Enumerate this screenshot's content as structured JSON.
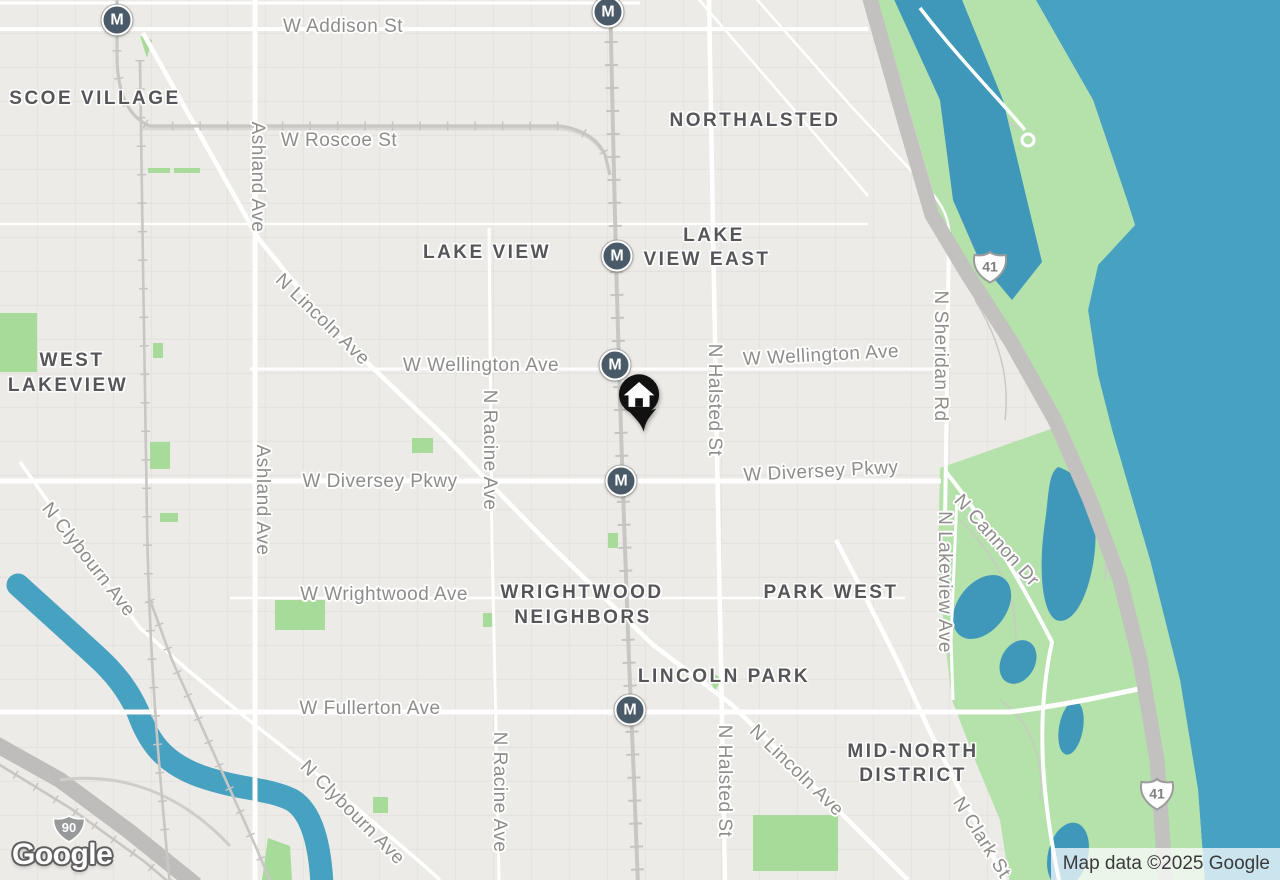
{
  "map": {
    "provider_logo": "Google",
    "attribution": "Map data ©2025 Google",
    "transit": {
      "symbol": "M"
    },
    "shields": {
      "interstate": "90",
      "us_route": "41"
    },
    "neighborhoods": [
      "SCOE VILLAGE",
      "NORTHALSTED",
      "LAKE VIEW",
      "LAKE",
      "VIEW EAST",
      "WEST",
      "LAKEVIEW",
      "WRIGHTWOOD",
      "NEIGHBORS",
      "PARK WEST",
      "LINCOLN PARK",
      "MID-NORTH",
      "DISTRICT"
    ],
    "streets": [
      "W Addison St",
      "W Roscoe St",
      "Ashland Ave",
      "Ashland Ave",
      "N Lincoln Ave",
      "W Wellington Ave",
      "W Wellington Ave",
      "N Racine Ave",
      "N Racine Ave",
      "W Diversey Pkwy",
      "W Diversey Pkwy",
      "W Wrightwood Ave",
      "W Fullerton Ave",
      "N Clybourn Ave",
      "N Clybourn Ave",
      "N Halsted St",
      "N Halsted St",
      "N Lincoln Ave",
      "N Clark St",
      "N Sheridan Rd",
      "N Cannon Dr",
      "N Lakeview Ave"
    ],
    "colors": {
      "background": "#edebe7",
      "water": "#47a1c1",
      "pond": "#3f98ba",
      "park": "#b5e1ab",
      "park_bright": "#a7db9a",
      "road_white": "#ffffff",
      "road_gray": "#dad8d4",
      "highway": "#bebdbb",
      "rail": "#c9c7c4",
      "street_label": "#8e8d8b",
      "neighborhood_label": "#56565a",
      "transit_marker": "#4a5a68"
    }
  }
}
